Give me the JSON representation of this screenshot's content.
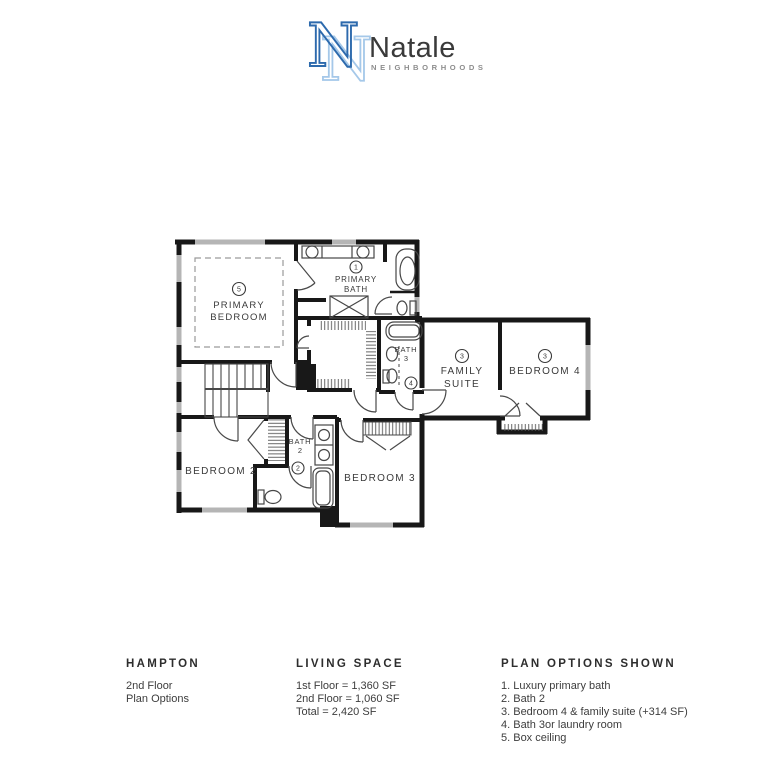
{
  "logo": {
    "monogram": "N",
    "brand": "Natale",
    "subtitle": "NEIGHBORHOODS",
    "colors": {
      "dark_blue": "#2d6aad",
      "light_blue": "#a5c8e9",
      "brand_text": "#3a3a3a",
      "subtitle_text": "#8d8d8d"
    }
  },
  "plan": {
    "rooms": {
      "primary_bedroom": {
        "num": "5",
        "l1": "PRIMARY",
        "l2": "BEDROOM"
      },
      "primary_bath": {
        "num": "1",
        "l1": "PRIMARY",
        "l2": "BATH"
      },
      "family_suite": {
        "num": "3",
        "l1": "FAMILY",
        "l2": "SUITE"
      },
      "bedroom4": {
        "num": "3",
        "label": "BEDROOM 4"
      },
      "bath3": {
        "num": "4",
        "l1": "BATH",
        "l2": "3"
      },
      "bath2": {
        "num": "2",
        "l1": "BATH",
        "l2": "2"
      },
      "bedroom2": {
        "label": "BEDROOM 2"
      },
      "bedroom3": {
        "label": "BEDROOM 3"
      }
    }
  },
  "footer": {
    "plan_name": {
      "title": "HAMPTON",
      "line1": "2nd Floor",
      "line2": "Plan Options"
    },
    "living_space": {
      "title": "LIVING SPACE",
      "line1": "1st Floor = 1,360 SF",
      "line2": "2nd Floor = 1,060 SF",
      "line3": "Total = 2,420 SF"
    },
    "options": {
      "title": "PLAN OPTIONS SHOWN",
      "items": [
        "1. Luxury primary bath",
        "2. Bath 2",
        "3. Bedroom 4 & family suite (+314 SF)",
        "4. Bath 3or laundry room",
        "5. Box ceiling"
      ]
    }
  }
}
